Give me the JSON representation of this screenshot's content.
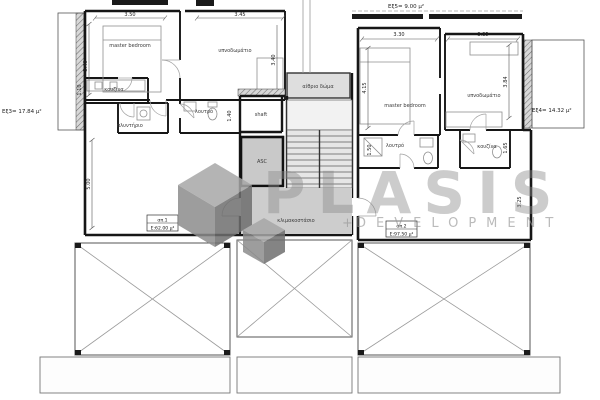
{
  "watermark": {
    "brand": "PLASIS",
    "plus": "+",
    "tagline": "DEVELOPMENT",
    "gray": "#8d8d8d"
  },
  "annotations": {
    "ext_left": "Εξ3= 17.84 μ²",
    "ext_right": "Εξ4= 14.32 μ²",
    "ext_top": "Εξ5= 9.00 μ²"
  },
  "core": {
    "atrium": "αίθριο δώμα",
    "shaft": "shaft",
    "elevator": "ASC",
    "stairwell": "κλιμακοστάσιο"
  },
  "apt1": {
    "unit": "απ.1",
    "area": "Ε:62.00 μ²",
    "rooms": {
      "master": "master bedroom",
      "bedroom": "υπνοδωμάτιο",
      "kitchen": "κουζίνα",
      "laundry": "πλυντήριο",
      "bath": "λουτρό"
    },
    "dims": {
      "w_master": "3.50",
      "w_bedroom": "3.45",
      "h_master": "3.40",
      "h_bedroom": "3.40",
      "h_kitchen": "1.10",
      "h_bath": "1.40",
      "h_living": "5.00"
    }
  },
  "apt2": {
    "unit": "απ.2",
    "area": "Ε:97.50 μ²",
    "rooms": {
      "master": "master bedroom",
      "bedroom": "υπνοδωμάτιο",
      "bath": "λουτρό",
      "kitchen": "κουζίνα"
    },
    "dims": {
      "w_master": "3.30",
      "w_bedroom": "3.35",
      "h_master": "4.15",
      "h_bedroom": "3.84",
      "h_bath": "1.50",
      "h_kitchen": "1.65",
      "h_living": "3.25"
    }
  },
  "colors": {
    "wall": "#161616",
    "core_fill": "#cdcdcd",
    "atrium_fill": "#dedede"
  }
}
